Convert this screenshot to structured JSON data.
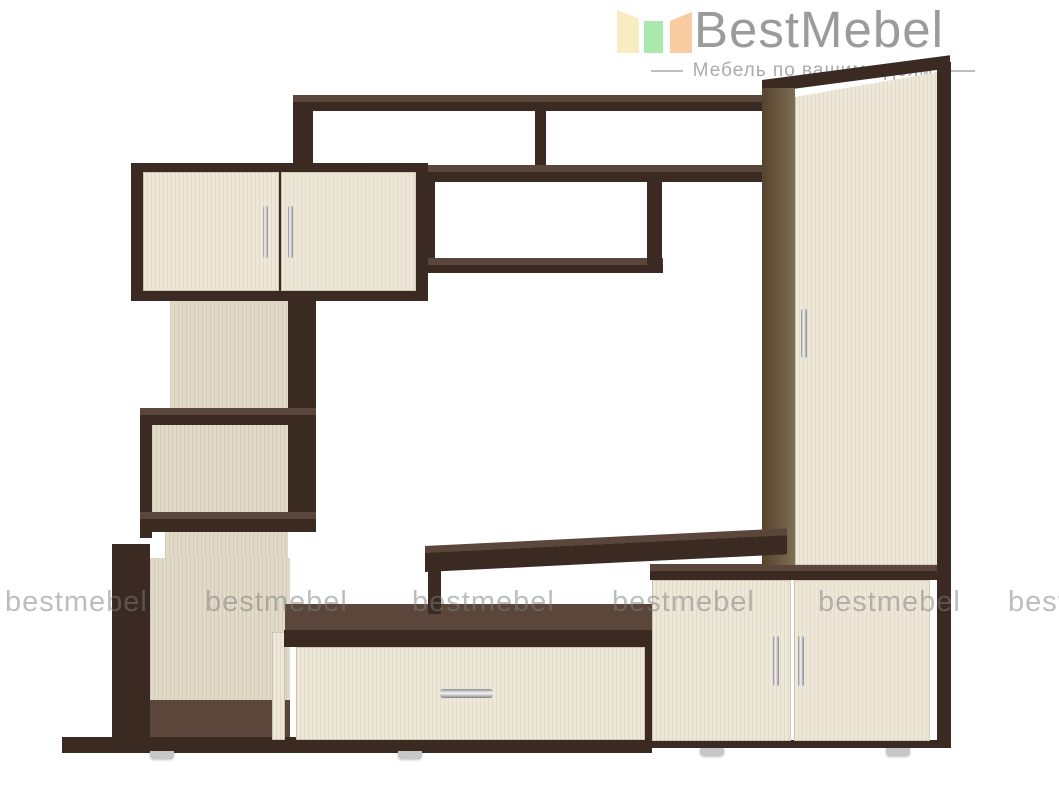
{
  "brand": {
    "name": "BestMebel",
    "tagline": "Мебель по вашим идеям",
    "logo_icon": "furniture-panels-icon"
  },
  "watermark": {
    "text": "bestmebel",
    "count": 6
  },
  "colors": {
    "logo_yellow": "#F8ECC3",
    "logo_green": "#A9E9AD",
    "logo_orange": "#F8CBA1",
    "logo_text": "#9B9B9B",
    "tagline_text": "#ABABAB",
    "frame_dark": "#3B2A22",
    "frame_mid": "#5A463A",
    "door_cream": "#EDE7D8",
    "panel_back": "#E1DAC8",
    "side_olive_dark": "#57432E",
    "side_olive_light": "#7C6F52",
    "handle_chrome": "#D9D9D9",
    "foot_gray": "#C7C7C7",
    "watermark_gray": "#7D7D7D"
  }
}
